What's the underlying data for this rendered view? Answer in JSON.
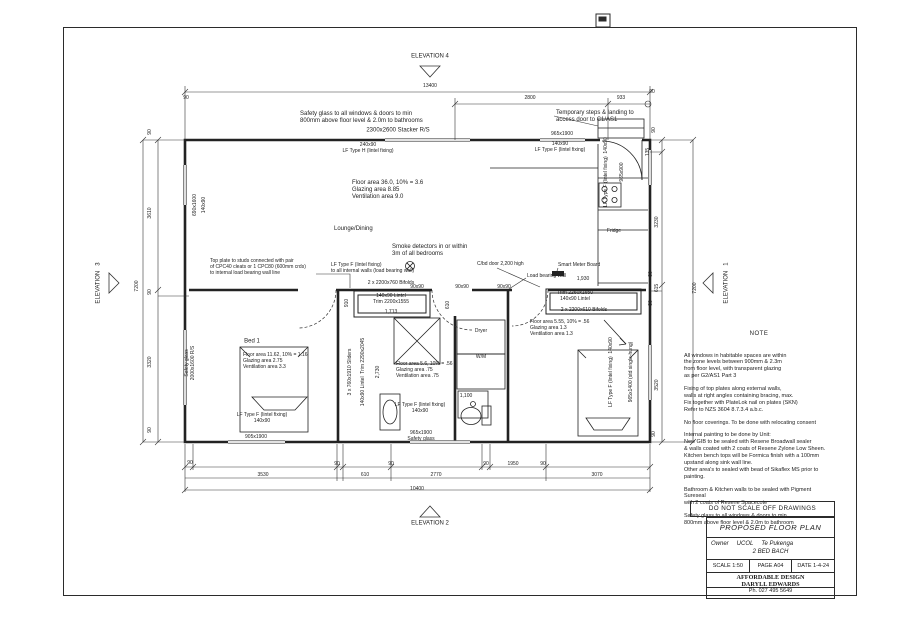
{
  "title_block": {
    "do_not_scale": "DO NOT SCALE OFF DRAWINGS",
    "drawing_title": "PROPOSED  FLOOR PLAN",
    "owner_label": "Owner",
    "owner_name": "UCOL",
    "owner_name2": "Te Pukenga",
    "project": "2  BED BACH",
    "scale": "SCALE 1:50",
    "page": "PAGE  A04",
    "date": "DATE 1-4-24",
    "designer": "AFFORDABLE DESIGN\nDARYLL EDWARDS",
    "phone": "Ph. 027 495 5649"
  },
  "notes": {
    "heading": "NOTE",
    "p1": "All windows in habitable spaces are within\nthe zone levels between 900mm & 2.3m\nfrom floor level, with transparent glazing\nas per G2/AS1 Part 3",
    "p2": "Fixing of top plates along external walls,\nwalls at right angles containing bracing, max.\nFix together with PlateLok nail on plates (SKN)\nRefer to NZS 3604 8.7.3.4 a.b.c.",
    "p3": "No floor coverings. To be done with relocating consent",
    "p4": "Internal painting to be done by Unit:\nNew GIB to be sealed with Resene Broadwall sealer\n& walls coated with 2 coats of Resene Zylone Low Sheen.\nKitchen bench tops will be Formica finish with a 100mm\nupstand along sink wall line.\nOther area's to sealed with bead of Sikaflex MS prior to\npainting.",
    "p5": "Bathroom & Kitchen walls to be sealed with Pigment Sureseal\nwith 2 coats of Resene Spacecote",
    "p6": "Safety glass to all windows & doors to min\n800mm above floor level & 2.0m to bathroom"
  },
  "plan": {
    "labels": [
      {
        "t": "ELEVATION   4",
        "x": 430,
        "y": 57,
        "c": "c"
      },
      {
        "t": "13400",
        "x": 430,
        "y": 87,
        "c": "c s"
      },
      {
        "t": "90",
        "x": 186,
        "y": 99,
        "c": "c s"
      },
      {
        "t": "2800",
        "x": 530,
        "y": 99,
        "c": "c s"
      },
      {
        "t": "933",
        "x": 621,
        "y": 99,
        "c": "c s"
      },
      {
        "t": "90",
        "x": 652,
        "y": 93,
        "c": "c s"
      },
      {
        "t": "Safety glass to all windows & doors to min\n800mm above floor level & 2.0m to bathrooms",
        "x": 300,
        "y": 111,
        "c": "l"
      },
      {
        "t": "Temporary steps & landing to\naccess door to C1/AS1",
        "x": 556,
        "y": 110,
        "c": "l"
      },
      {
        "t": "2300x2600 Stacker R/S",
        "x": 398,
        "y": 131,
        "c": "c"
      },
      {
        "t": "965x1900",
        "x": 562,
        "y": 135,
        "c": "c s"
      },
      {
        "t": "240x90\nLF Type H (lintel fixing)",
        "x": 368,
        "y": 149,
        "c": "c s"
      },
      {
        "t": "140x90\nLF Type F (lintel fixing)",
        "x": 560,
        "y": 148,
        "c": "c s"
      },
      {
        "t": "LF Type F (lintel fixing)  140x90",
        "x": 607,
        "y": 172,
        "c": "v s"
      },
      {
        "t": "965x900",
        "x": 623,
        "y": 172,
        "c": "v s"
      },
      {
        "t": "90",
        "x": 655,
        "y": 130,
        "c": "v s"
      },
      {
        "t": "135",
        "x": 649,
        "y": 152,
        "c": "v s"
      },
      {
        "t": "3230",
        "x": 658,
        "y": 222,
        "c": "v s"
      },
      {
        "t": "Floor area 36.0,  10% = 3.6\nGlazing area         8.85\nVentilation area     9.0",
        "x": 352,
        "y": 180,
        "c": "l"
      },
      {
        "t": "Lounge/Dining",
        "x": 334,
        "y": 226,
        "c": "l"
      },
      {
        "t": "Smoke detectors in or within\n3m of all bedrooms",
        "x": 392,
        "y": 244,
        "c": "l"
      },
      {
        "t": "LF Type F (lintel fixing)\nto all internal walls (load bearing wall)",
        "x": 331,
        "y": 263,
        "c": "l s"
      },
      {
        "t": "C/bd door 2,200 high",
        "x": 477,
        "y": 262,
        "c": "l s"
      },
      {
        "t": "Load bearing wall",
        "x": 527,
        "y": 274,
        "c": "l s"
      },
      {
        "t": "Top plate to studs connected with pair\nof CPC40 cleats or 1 CPC80 (600mm crds)\nto internal load bearing wall line",
        "x": 210,
        "y": 259,
        "c": "l s"
      },
      {
        "t": "90x90",
        "x": 417,
        "y": 288,
        "c": "c s"
      },
      {
        "t": "90x90",
        "x": 462,
        "y": 288,
        "c": "c s"
      },
      {
        "t": "90x90",
        "x": 504,
        "y": 288,
        "c": "c s"
      },
      {
        "t": "2 x 2200x760 Bifolds",
        "x": 391,
        "y": 284,
        "c": "c s"
      },
      {
        "t": "140x90 Lintel\nTrim 2200x1555",
        "x": 391,
        "y": 300,
        "c": "c s"
      },
      {
        "t": "1,713",
        "x": 391,
        "y": 313,
        "c": "c s"
      },
      {
        "t": "910",
        "x": 348,
        "y": 303,
        "c": "v s"
      },
      {
        "t": "610",
        "x": 449,
        "y": 305,
        "c": "v s"
      },
      {
        "t": "Bed 1",
        "x": 252,
        "y": 342,
        "c": "c"
      },
      {
        "t": "Floor area 11.62,  10% = 1.16\nGlazing area         2.75\nVentilation area     3.3",
        "x": 243,
        "y": 353,
        "c": "l s"
      },
      {
        "t": "LF Type F (lintel fixing)\n140x90",
        "x": 262,
        "y": 419,
        "c": "c s"
      },
      {
        "t": "905x1900",
        "x": 256,
        "y": 438,
        "c": "c s"
      },
      {
        "t": "3 x 760x1910 Sliders",
        "x": 351,
        "y": 372,
        "c": "v s"
      },
      {
        "t": "140x90 Lintel  Trim 2290x2045",
        "x": 364,
        "y": 372,
        "c": "v s"
      },
      {
        "t": "2,730",
        "x": 379,
        "y": 372,
        "c": "v s"
      },
      {
        "t": "Floor area 5.6,  10% = .56\nGlazing area         .75\nVentilation area     .75",
        "x": 396,
        "y": 362,
        "c": "l s"
      },
      {
        "t": "Dryer",
        "x": 481,
        "y": 332,
        "c": "c s"
      },
      {
        "t": "W/M",
        "x": 481,
        "y": 358,
        "c": "c s"
      },
      {
        "t": "1,100",
        "x": 466,
        "y": 397,
        "c": "c s"
      },
      {
        "t": "LF Type F (lintel fixing)\n140x90",
        "x": 420,
        "y": 409,
        "c": "c s"
      },
      {
        "t": "965x1900\nSafety glass",
        "x": 421,
        "y": 437,
        "c": "c s"
      },
      {
        "t": "Floor area 5.55,  10% = .56\nGlazing area         1.3\nVentilation area     1.3",
        "x": 530,
        "y": 320,
        "c": "l s"
      },
      {
        "t": "1,930",
        "x": 583,
        "y": 280,
        "c": "c s"
      },
      {
        "t": "Trim 2260x1650\n140x90 Lintel",
        "x": 575,
        "y": 297,
        "c": "c s"
      },
      {
        "t": "2 x 2200x610 Bifolds",
        "x": 584,
        "y": 311,
        "c": "c s"
      },
      {
        "t": "LF Type F (lintel fixing)  140x90",
        "x": 612,
        "y": 372,
        "c": "v s"
      },
      {
        "t": "965x1400 (std single-hung)",
        "x": 632,
        "y": 372,
        "c": "v s"
      },
      {
        "t": "Fridge",
        "x": 614,
        "y": 232,
        "c": "c s"
      },
      {
        "t": "Smart Meter Board",
        "x": 558,
        "y": 263,
        "c": "l s"
      },
      {
        "t": "690x1600",
        "x": 196,
        "y": 205,
        "c": "v s"
      },
      {
        "t": "140x90",
        "x": 205,
        "y": 205,
        "c": "v s"
      },
      {
        "t": "Safety glass\n2000x1600 R/S",
        "x": 191,
        "y": 363,
        "c": "v s"
      },
      {
        "t": "90",
        "x": 151,
        "y": 132,
        "c": "v s"
      },
      {
        "t": "3610",
        "x": 151,
        "y": 213,
        "c": "v s"
      },
      {
        "t": "90",
        "x": 151,
        "y": 292,
        "c": "v s"
      },
      {
        "t": "3320",
        "x": 151,
        "y": 362,
        "c": "v s"
      },
      {
        "t": "90",
        "x": 151,
        "y": 430,
        "c": "v s"
      },
      {
        "t": "7200",
        "x": 138,
        "y": 286,
        "c": "v s"
      },
      {
        "t": "ELEVATION   3",
        "x": 99,
        "y": 283,
        "c": "v"
      },
      {
        "t": "90",
        "x": 652,
        "y": 274,
        "c": "v s"
      },
      {
        "t": "615",
        "x": 658,
        "y": 288,
        "c": "v s"
      },
      {
        "t": "90",
        "x": 652,
        "y": 303,
        "c": "v s"
      },
      {
        "t": "3520",
        "x": 658,
        "y": 385,
        "c": "v s"
      },
      {
        "t": "90",
        "x": 655,
        "y": 434,
        "c": "v s"
      },
      {
        "t": "7200",
        "x": 696,
        "y": 288,
        "c": "v s"
      },
      {
        "t": "ELEVATION   1",
        "x": 727,
        "y": 283,
        "c": "v"
      },
      {
        "t": "90",
        "x": 190,
        "y": 464,
        "c": "c s"
      },
      {
        "t": "3530",
        "x": 263,
        "y": 476,
        "c": "c s"
      },
      {
        "t": "90",
        "x": 337,
        "y": 465,
        "c": "c s"
      },
      {
        "t": "610",
        "x": 365,
        "y": 476,
        "c": "c s"
      },
      {
        "t": "90",
        "x": 391,
        "y": 465,
        "c": "c s"
      },
      {
        "t": "2770",
        "x": 436,
        "y": 476,
        "c": "c s"
      },
      {
        "t": "90",
        "x": 486,
        "y": 465,
        "c": "c s"
      },
      {
        "t": "1950",
        "x": 513,
        "y": 465,
        "c": "c s"
      },
      {
        "t": "90",
        "x": 543,
        "y": 465,
        "c": "c s"
      },
      {
        "t": "3070",
        "x": 597,
        "y": 476,
        "c": "c s"
      },
      {
        "t": "10400",
        "x": 417,
        "y": 490,
        "c": "c s"
      },
      {
        "t": "ELEVATION   2",
        "x": 430,
        "y": 524,
        "c": "c"
      }
    ]
  }
}
